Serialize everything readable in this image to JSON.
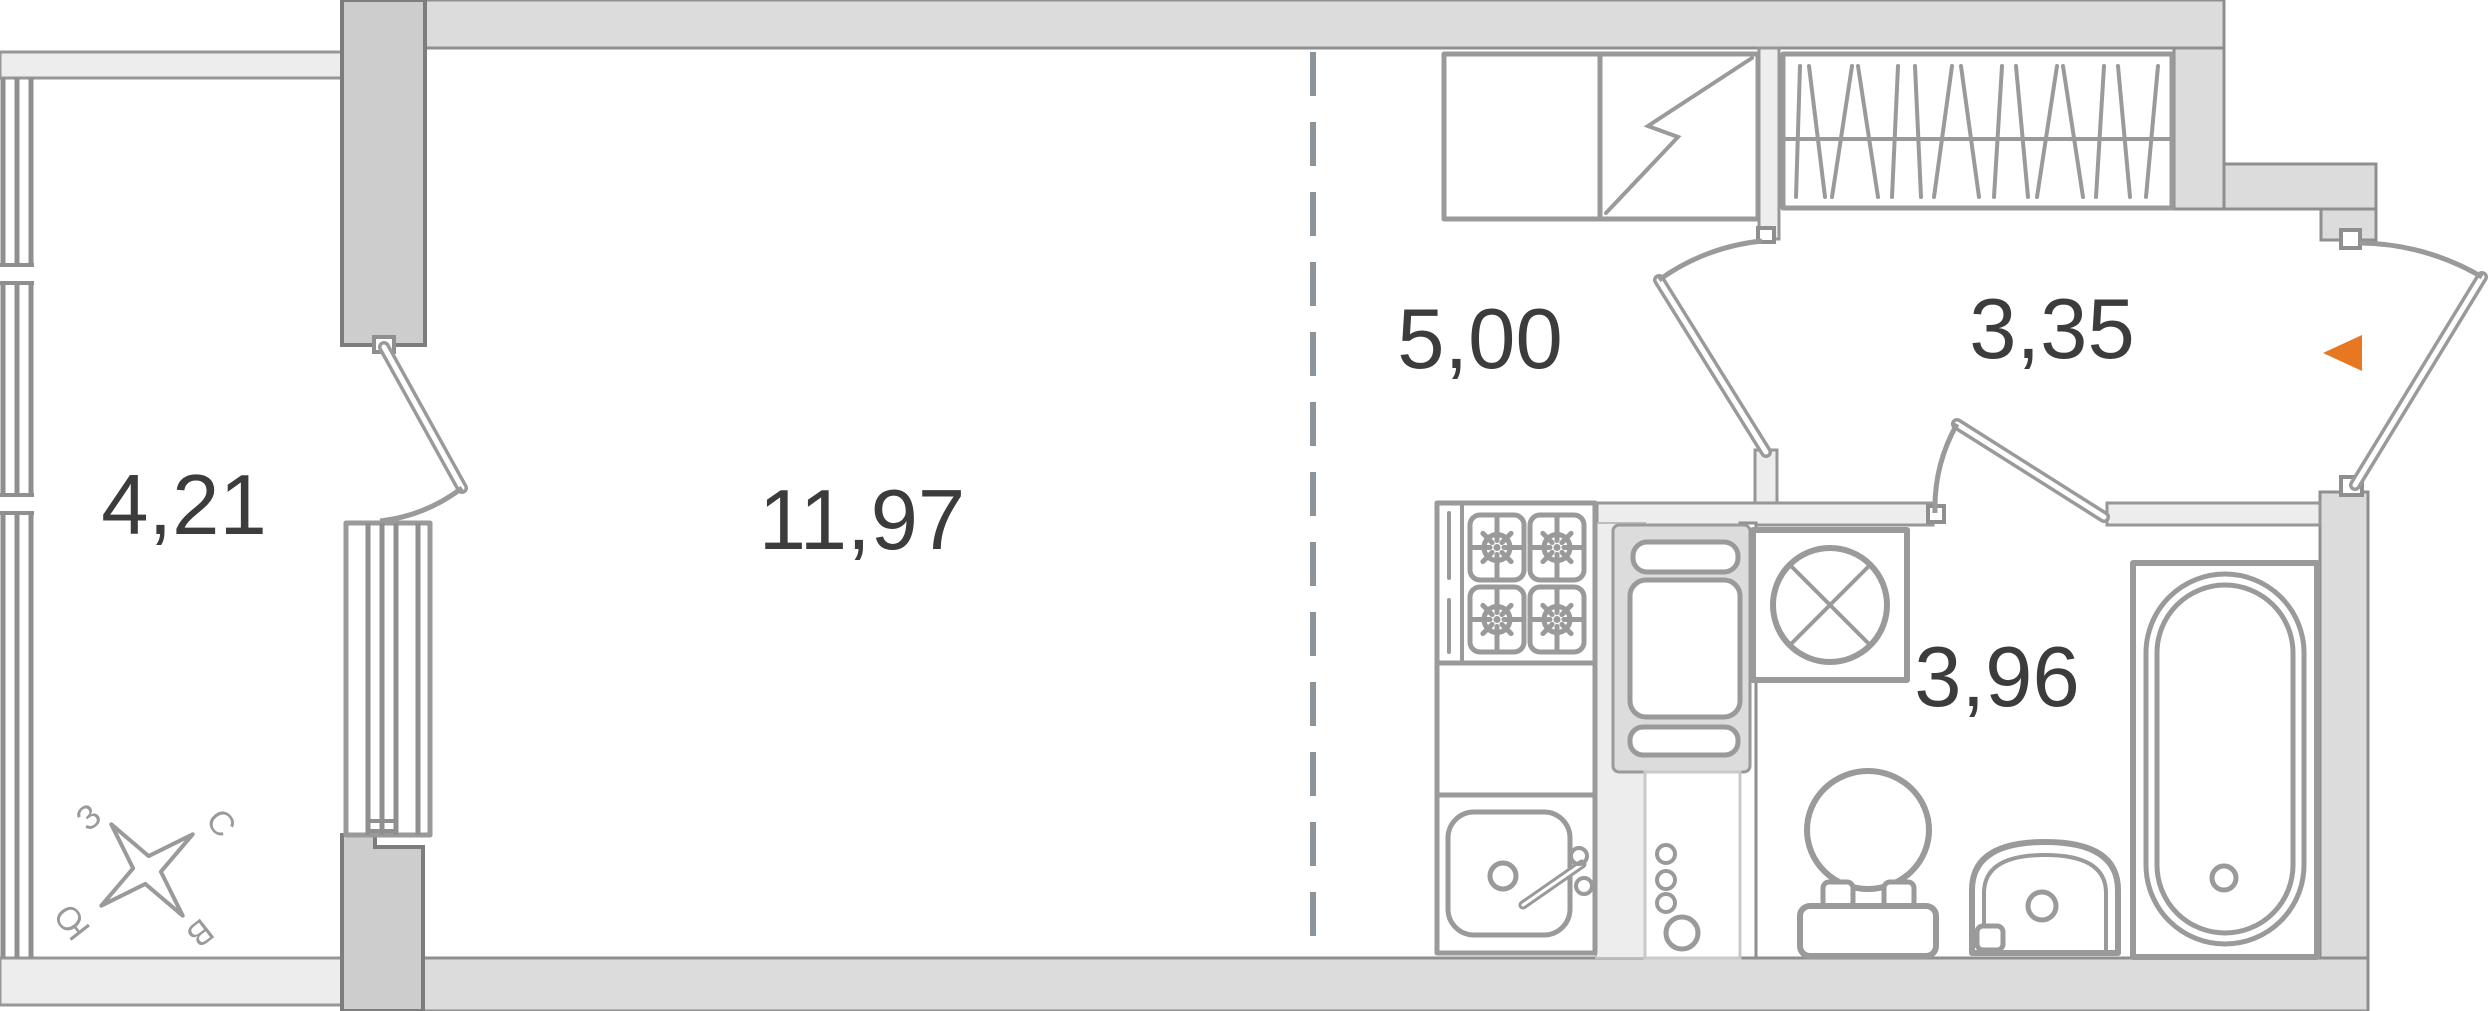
{
  "floor_plan": {
    "rooms": [
      {
        "name": "balcony",
        "area": "4,21"
      },
      {
        "name": "living-room",
        "area": "11,97"
      },
      {
        "name": "kitchen",
        "area": "5,00"
      },
      {
        "name": "hallway",
        "area": "3,35"
      },
      {
        "name": "bathroom",
        "area": "3,96"
      }
    ],
    "compass": {
      "west": "З",
      "north": "С",
      "south": "Ю",
      "east": "В"
    },
    "icons": [
      "compass-rose-icon",
      "entrance-arrow-icon",
      "fridge-icon",
      "electrical-panel-icon",
      "wardrobe-icon",
      "stove-icon",
      "kitchen-sink-icon",
      "kitchen-counter-icon",
      "riser-pipes-icon",
      "washing-machine-icon",
      "toilet-icon",
      "bathroom-sink-icon",
      "bathtub-icon"
    ],
    "colors": {
      "wall": "#dcdcdc",
      "wall_light": "#ededed",
      "pylon": "#cdcdcd",
      "outline": "#8f8f8f",
      "fixture": "#9a9a9a",
      "label": "#3c3c3c",
      "zone_dash": "#8a949a",
      "entrance_arrow": "#e87722"
    }
  }
}
